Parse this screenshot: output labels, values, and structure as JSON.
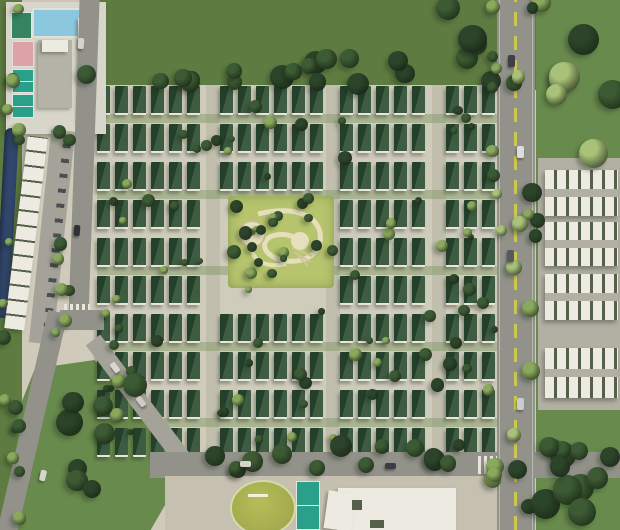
{
  "meta": {
    "description": "Aerial 3D masterplan render of a villa township: rows of dark-green-roof villas around a central landscaped park, clubhouse with pool and courts at north-west, white row-house blocks on the east side, arterial road with yellow median, sports zone at south",
    "type": "site-plan-render"
  },
  "palette": {
    "ground": "#cfcab9",
    "field": "#5e7c41",
    "field2": "#688a4c",
    "housing_ground": "#d0ccbc",
    "street": "#c2beae",
    "pavement": "#c6c0b1",
    "road": "#92928a",
    "road_light": "#a5a399",
    "yellow": "#cdc84e",
    "roof_dark": "#24402b",
    "roof_light": "#3e5c42",
    "wall": "#e9e6d8",
    "park": "#b6c46e",
    "path_cream": "#e6dfbc",
    "white_bldg": "#edebe1",
    "white_base": "#b2afa3",
    "unit_dark": "#55604b",
    "club_base": "#d8d6ca",
    "bldg_gray": "#b5b2a8",
    "water": "#31466b",
    "pool": "#8cc8dd",
    "pool_deck": "#dfe0d6",
    "teal": "#2aa08b",
    "pink": "#dca3a6",
    "court_green": "#35835f",
    "track_field": "#b7bd58",
    "tree_dark": "#2c452a",
    "tree_mid": "#3c5a33",
    "tree_light": "#8aa95c",
    "tree_pale": "#a9c178",
    "shadow": "rgba(30,40,25,0.35)"
  },
  "features": [
    {
      "id": "clubhouse-complex",
      "label": "North-west clubhouse with swimming pool and sports courts"
    },
    {
      "id": "swimming-pool",
      "label": "Swimming pool"
    },
    {
      "id": "sports-courts",
      "label": "Tennis / multipurpose courts (teal, green, pink)"
    },
    {
      "id": "central-park",
      "label": "Central landscaped park with circular plaza and walking loop"
    },
    {
      "id": "villa-grid",
      "label": "Rows of villas with dark green roofs"
    },
    {
      "id": "row-houses-east",
      "label": "White-roof row-house blocks on east strip"
    },
    {
      "id": "main-road-east",
      "label": "North-south arterial road with yellow median line"
    },
    {
      "id": "perimeter-road-west",
      "label": "West perimeter road bending to south-west corner"
    },
    {
      "id": "linear-building-west",
      "label": "Long linear building along west edge"
    },
    {
      "id": "water-channel",
      "label": "Water channel on west edge"
    },
    {
      "id": "sports-zone-south",
      "label": "South sports zone: oval lawn, tennis court, clubhouse building"
    },
    {
      "id": "pocket-park-southwest",
      "label": "Triangular pocket park with mature trees"
    },
    {
      "id": "green-field-north",
      "label": "Open green field to the north"
    }
  ],
  "housing": {
    "unit_w": 13,
    "unit_h": 27,
    "gap": 5,
    "blocks": [
      [
        97,
        206
      ],
      [
        220,
        326
      ],
      [
        340,
        432
      ],
      [
        446,
        497
      ]
    ],
    "rows": [
      {
        "y": 86,
        "back": 1
      },
      {
        "y": 124
      },
      {
        "y": 162,
        "back": 1
      },
      {
        "y": 200,
        "skipBlock": 1
      },
      {
        "y": 238,
        "skipBlock": 1,
        "back": 1
      },
      {
        "y": 276,
        "skipBlock": 1
      },
      {
        "y": 314,
        "back": 1
      },
      {
        "y": 352
      },
      {
        "y": 390,
        "back": 1
      },
      {
        "y": 428
      }
    ]
  },
  "row_houses": {
    "x": 545,
    "w": 73,
    "rows": [
      {
        "y": 170,
        "h": 46
      },
      {
        "y": 222,
        "h": 44
      },
      {
        "y": 274,
        "h": 46
      },
      {
        "y": 348,
        "h": 50
      }
    ]
  },
  "trees": [
    {
      "x": 85,
      "y": 58,
      "w": 450,
      "h": 26,
      "n": 18,
      "rmin": 7,
      "rmax": 12,
      "colors": [
        "tree_dark",
        "tree_mid"
      ],
      "seed": 7
    },
    {
      "x": 95,
      "y": 90,
      "w": 405,
      "h": 362,
      "n": 85,
      "rmin": 3,
      "rmax": 7,
      "colors": [
        "tree_mid",
        "tree_light",
        "tree_dark"
      ],
      "seed": 11
    },
    {
      "x": 486,
      "y": 0,
      "w": 12,
      "h": 530,
      "n": 9,
      "rmin": 5,
      "rmax": 9,
      "colors": [
        "tree_mid",
        "tree_light"
      ],
      "seed": 3
    },
    {
      "x": 528,
      "y": 0,
      "w": 16,
      "h": 530,
      "n": 9,
      "rmin": 5,
      "rmax": 10,
      "colors": [
        "tree_dark",
        "tree_light"
      ],
      "seed": 5
    },
    {
      "x": 540,
      "y": 5,
      "w": 75,
      "h": 160,
      "n": 6,
      "rmin": 10,
      "rmax": 16,
      "colors": [
        "tree_mid",
        "tree_dark",
        "tree_pale"
      ],
      "seed": 13
    },
    {
      "x": 540,
      "y": 400,
      "w": 75,
      "h": 125,
      "n": 6,
      "rmin": 10,
      "rmax": 15,
      "colors": [
        "tree_mid",
        "tree_dark"
      ],
      "seed": 17
    },
    {
      "x": 385,
      "y": 5,
      "w": 100,
      "h": 65,
      "n": 5,
      "rmin": 10,
      "rmax": 15,
      "colors": [
        "tree_dark",
        "tree_mid"
      ],
      "seed": 19
    },
    {
      "x": 160,
      "y": 446,
      "w": 455,
      "h": 28,
      "n": 20,
      "rmin": 7,
      "rmax": 11,
      "colors": [
        "tree_dark",
        "tree_mid"
      ],
      "seed": 23
    },
    {
      "x": 40,
      "y": 385,
      "w": 115,
      "h": 130,
      "n": 8,
      "rmin": 9,
      "rmax": 14,
      "colors": [
        "tree_mid",
        "tree_dark"
      ],
      "seed": 29
    },
    {
      "x": 0,
      "y": 0,
      "w": 20,
      "h": 525,
      "n": 16,
      "rmin": 4,
      "rmax": 8,
      "colors": [
        "tree_mid",
        "tree_light"
      ],
      "seed": 31
    },
    {
      "x": 50,
      "y": 130,
      "w": 22,
      "h": 215,
      "n": 8,
      "rmin": 4,
      "rmax": 7,
      "colors": [
        "tree_mid",
        "tree_light"
      ],
      "seed": 37
    },
    {
      "x": 226,
      "y": 190,
      "w": 110,
      "h": 100,
      "n": 9,
      "rmin": 4,
      "rmax": 7,
      "colors": [
        "tree_dark",
        "tree_mid"
      ],
      "seed": 41
    },
    {
      "x": 490,
      "y": 60,
      "w": 48,
      "h": 400,
      "n": 6,
      "rmin": 5,
      "rmax": 8,
      "colors": [
        "tree_pale"
      ],
      "seed": 43
    }
  ],
  "cars": [
    {
      "x": 508,
      "y": 55,
      "w": 7,
      "h": 12,
      "c": "#3b4046",
      "a": 0
    },
    {
      "x": 517,
      "y": 146,
      "w": 7,
      "h": 12,
      "c": "#dcdcda",
      "a": 0
    },
    {
      "x": 507,
      "y": 250,
      "w": 7,
      "h": 12,
      "c": "#555a60",
      "a": 0
    },
    {
      "x": 517,
      "y": 398,
      "w": 7,
      "h": 12,
      "c": "#c9cdd1",
      "a": 0
    },
    {
      "x": 78,
      "y": 38,
      "w": 6,
      "h": 11,
      "c": "#d6d4cf",
      "a": 4
    },
    {
      "x": 74,
      "y": 225,
      "w": 6,
      "h": 11,
      "c": "#2f3338",
      "a": 4
    },
    {
      "x": 112,
      "y": 362,
      "w": 6,
      "h": 11,
      "c": "#dad7ce",
      "a": -37
    },
    {
      "x": 138,
      "y": 396,
      "w": 6,
      "h": 11,
      "c": "#cfccc3",
      "a": -37
    },
    {
      "x": 240,
      "y": 461,
      "w": 11,
      "h": 6,
      "c": "#d6d3ca",
      "a": 0
    },
    {
      "x": 385,
      "y": 463,
      "w": 11,
      "h": 6,
      "c": "#3a3e44",
      "a": 0
    },
    {
      "x": 40,
      "y": 470,
      "w": 6,
      "h": 11,
      "c": "#d8d5cc",
      "a": 13
    }
  ]
}
